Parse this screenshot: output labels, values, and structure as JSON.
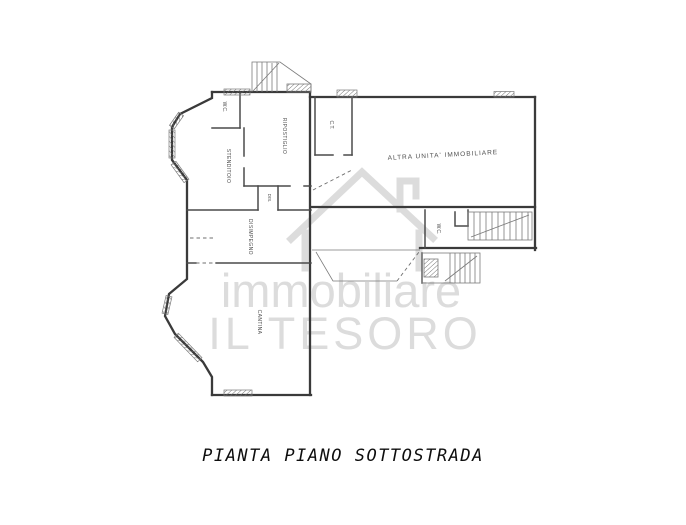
{
  "title": "PIANTA PIANO SOTTOSTRADA",
  "watermark": {
    "brand_top": "immobiliare",
    "brand_bottom": "IL TESORO",
    "icon": "house-icon",
    "color": "#dcdcdc"
  },
  "rooms": {
    "wc_left": "W.C.",
    "stenditoio": "STENDITOIO",
    "ripostiglio": "RIPOSTIGLIO",
    "ct": "C.T.",
    "dis": "DIS.",
    "disimpegno": "DISIMPEGNO",
    "altra_unita": "ALTRA UNITA' IMMOBILIARE",
    "wc_right": "W.C.",
    "cantina": "CANTINA"
  },
  "colors": {
    "wall": "#3a3a3a",
    "inner_wall": "#4a4a4a",
    "thin_line": "#7a7a7a",
    "label": "#4f4f4f",
    "watermark": "#dcdcdc",
    "caption": "#0e0e0e",
    "background": "#ffffff"
  }
}
